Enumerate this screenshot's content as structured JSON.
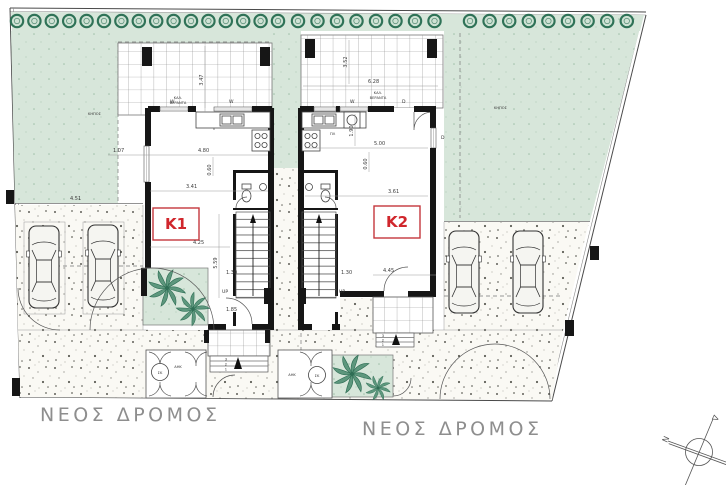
{
  "site": {
    "tree_groups": [
      {
        "x": 17,
        "count": 16,
        "step": 17.4
      },
      {
        "x": 298,
        "count": 8,
        "step": 19.5
      },
      {
        "x": 470,
        "count": 9,
        "step": 19.6
      }
    ],
    "garden_label_left": "ΚΗΠΟΣ",
    "garden_label_right": "ΚΗΠΟΣ",
    "road_label_left": "ΝΕΟΣ ΔΡΟΜΟΣ",
    "road_label_right": "ΝΕΟΣ ΔΡΟΜΟΣ",
    "parking_dim_left": "4.51"
  },
  "units": {
    "k1": {
      "name": "K1",
      "veranda_label_1": "ΚΑΛ.",
      "veranda_label_2": "ΒΕΡΑΝΤΑ",
      "up": "UP",
      "dims": {
        "veranda_h": "3.47",
        "offset": "1.07",
        "kitchen_w": "4.80",
        "wall": "0.60",
        "living_w": "3.41",
        "front_w": "4.25",
        "depth": "5.59",
        "stair": "1.30",
        "entry": "1.85"
      },
      "steps": [
        "3",
        "2",
        "1"
      ]
    },
    "k2": {
      "name": "K2",
      "veranda_label_1": "ΚΑΛ.",
      "veranda_label_2": "ΒΕΡΑΝΤΑ",
      "up": "UP",
      "dims": {
        "veranda_h": "3.52",
        "veranda_w": "6.28",
        "kitchen_d": "1.90",
        "kitchen_w": "5.00",
        "wall": "0.60",
        "living_w": "3.61",
        "front_w": "4.45",
        "stair": "1.30"
      },
      "steps": [
        "3",
        "2",
        "1"
      ]
    }
  },
  "annotations": {
    "window": "W",
    "door": "D",
    "washer": "ΠΛ",
    "meter": "ΑΗΚ",
    "manhole": "ΣΚ"
  },
  "compass": {
    "n": "N",
    "d": "Δ",
    "a": "A"
  }
}
